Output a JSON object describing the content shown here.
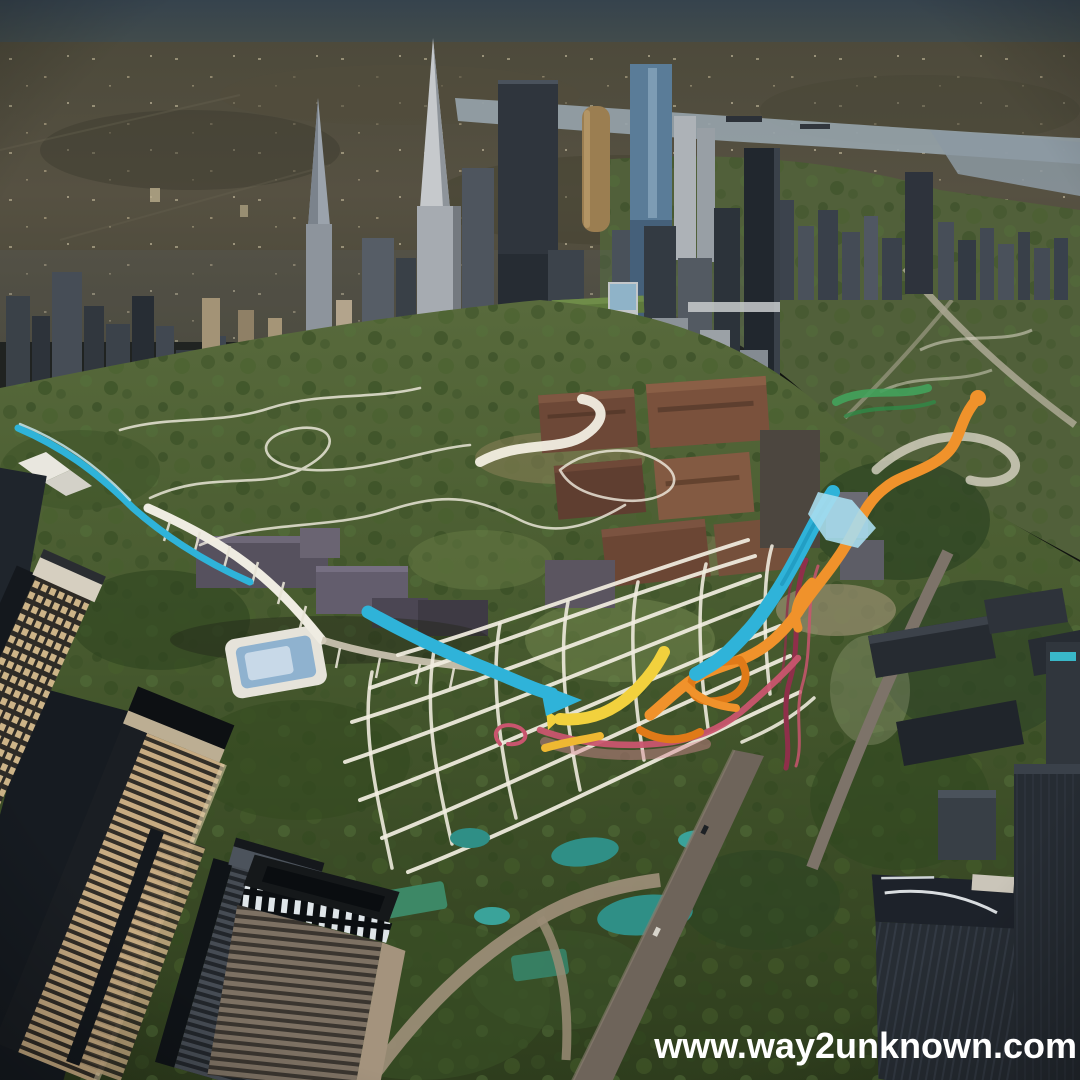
{
  "scene": {
    "type": "aerial-cityscape-render",
    "description": "Dusk aerial view of a downtown skyline behind a large urban park overlaid with a white masterplan path grid and colorful ribbon routes",
    "watermark": {
      "text": "www.way2unknown.com",
      "color": "#ffffff"
    }
  },
  "overlay": {
    "route_blue": "#2fb3d9",
    "route_blue_light": "#a9ddee",
    "route_blue_dark": "#1a8fb5",
    "route_orange": "#f0922b",
    "route_orange_deep": "#e07a18",
    "route_yellow": "#f2d13d",
    "route_yellow_deep": "#efb832",
    "route_pink": "#c9556e",
    "route_pink_soft": "#d98a96",
    "route_crimson": "#8f2f4a",
    "route_green": "#43a35c",
    "route_green_deep": "#2f8a47",
    "path_white": "#f2eee1",
    "pond_teal": "#2f8f86",
    "pond_teal_light": "#3aa39a"
  },
  "environment": {
    "sky": "#39464f",
    "sprawl": "#53503f",
    "river": "#97a4ac",
    "park": "#45572f"
  }
}
